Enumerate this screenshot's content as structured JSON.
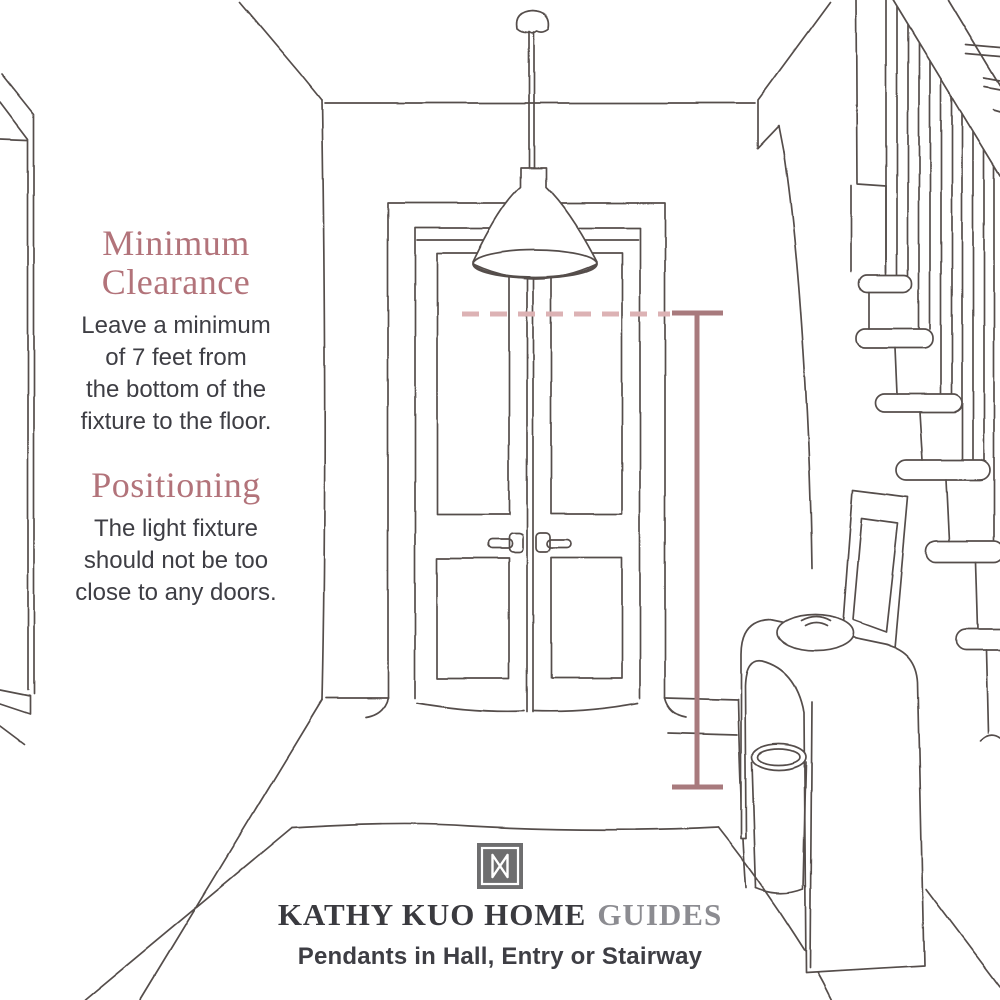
{
  "colors": {
    "background": "#ffffff",
    "ink": "#544e4b",
    "accent-heading": "#b2737a",
    "measure-line": "#a87a7d",
    "measure-dash": "#dcb2b4",
    "body-text": "#3e3e44",
    "brand-dark": "#3a3a3f",
    "brand-muted": "#8c8c91",
    "logo-bg": "#6e6e6f"
  },
  "notes": {
    "minimum_clearance": {
      "heading_lines": [
        "Minimum",
        "Clearance"
      ],
      "body_lines": [
        "Leave a minimum",
        "of 7 feet from",
        "the bottom of the",
        "fixture to the floor."
      ]
    },
    "positioning": {
      "heading_lines": [
        "Positioning"
      ],
      "body_lines": [
        "The light fixture",
        "should not be too",
        "close to any doors."
      ]
    }
  },
  "footer": {
    "logo_icon": "kathy-kuo-home-monogram",
    "brand": "KATHY KUO HOME",
    "brand_suffix": "GUIDES",
    "subtitle": "Pendants in Hall, Entry or Stairway"
  },
  "diagram": {
    "measurement": {
      "meaning": "Minimum 7 ft clearance from bottom of fixture to the floor",
      "type": "vertical-clearance-indicator with dashed fixture-bottom level line"
    }
  }
}
